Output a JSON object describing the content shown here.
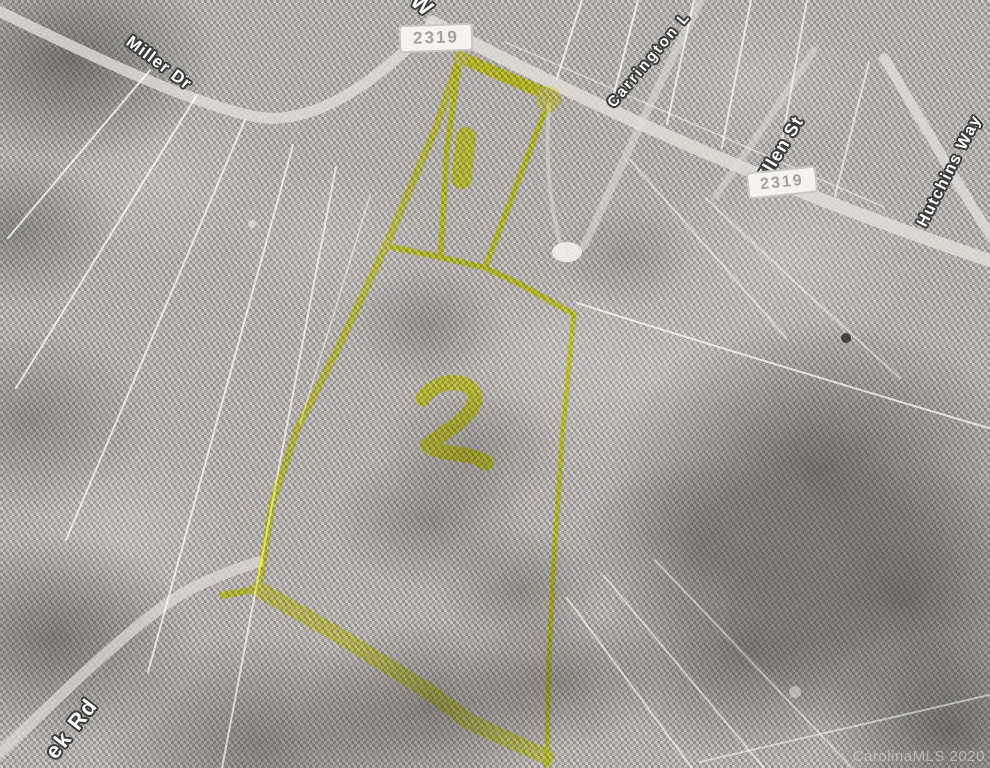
{
  "map": {
    "street_labels": [
      {
        "id": "miller-dr",
        "text": "Miller Dr"
      },
      {
        "id": "w-street",
        "text": "W"
      },
      {
        "id": "carrington-ln",
        "text": "Carrington L"
      },
      {
        "id": "ellen-st",
        "text": "Ellen St"
      },
      {
        "id": "hutchins-way",
        "text": "Hutchins Way"
      },
      {
        "id": "creek-rd",
        "text": "ek Rd"
      }
    ],
    "route_shields": [
      {
        "text": "2319"
      },
      {
        "text": "2319"
      }
    ],
    "parcel_numbers": [
      {
        "text": "1"
      },
      {
        "text": "2"
      }
    ],
    "watermark": "CarolinaMLS 2020",
    "colors": {
      "highlight": "#f6ff45",
      "highlight_bright": "#ffff9e",
      "shield_text": "#a4a2a0",
      "shield_bg": "#f4f3f1",
      "shield_border": "#c9c7c3",
      "label_text": "#ffffff",
      "label_halo": "#3c3c3a",
      "watermark_text": "#e3e3e1"
    },
    "geometry": {
      "outer_left": "460,57 436,128 387,244 340,345 297,430 272,505 259,589",
      "divider": "387,246 440,257 486,268 520,284 574,314",
      "right_edge": "574,314 563,430 554,560 549,660 547,768",
      "bottom_band": "259,589 340,636 430,692 470,722 547,757",
      "spur": "259,589 223,595",
      "parcel1_left": "460,57 447,150 441,253",
      "parcel1_top": "460,57 502,75 551,96",
      "parcel1_right": "551,96 515,190 486,266",
      "digit_1_path": "M466,137 L462,179",
      "digit_2_path": "M423,399 C433,381 463,377 473,391 C481,403 466,418 449,430 L428,445 C439,454 459,452 477,458 L487,463"
    }
  }
}
